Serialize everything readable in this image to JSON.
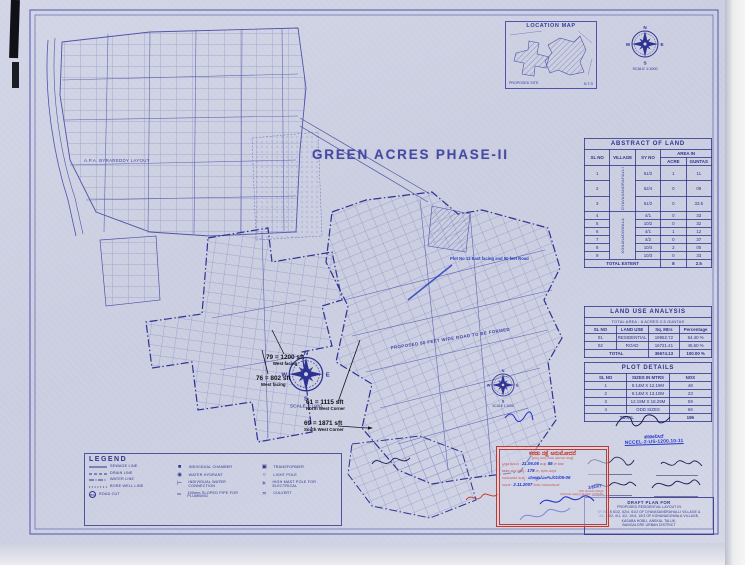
{
  "sheet": {
    "title": "GREEN ACRES PHASE-II",
    "scale_caption": "SCALE 1:1000",
    "compass": {
      "n": "N",
      "s": "S",
      "e": "E",
      "w": "W"
    },
    "area_label": "A.P.A. BYRAREDDY LAYOUT",
    "road_label": "PROPOSED 80 FEET WIDE ROAD TO BE FORMED",
    "blue_note": "Plot No 13 East facing and 50 feet Road",
    "annotations": [
      {
        "text": "79 = 1200 sft",
        "sub": "West facing"
      },
      {
        "text": "76 = 802 sft",
        "sub": "West facing"
      },
      {
        "text": "61 = 1115 sft",
        "sub": "North West Corner"
      },
      {
        "text": "69 = 1871 sft",
        "sub": "South West Corner"
      }
    ]
  },
  "location_map": {
    "title": "LOCATION MAP",
    "site_label": "PROPOSED SITE",
    "nts": "N.T.S"
  },
  "abstract": {
    "title": "ABSTRACT OF LAND",
    "headers": {
      "sl": "SL NO",
      "village": "VILLAGE",
      "sy": "SY NO",
      "area": "AREA IN",
      "acre": "ACRE",
      "guntas": "GUNTAS"
    },
    "villages": [
      "DYAVASANDRAHALLI",
      "KONANADOWALA"
    ],
    "rows": [
      {
        "sl": "1",
        "sy": "61/2",
        "acre": "1",
        "guntas": "11"
      },
      {
        "sl": "2",
        "sy": "62/4",
        "acre": "0",
        "guntas": "09"
      },
      {
        "sl": "3",
        "sy": "61/2",
        "acre": "0",
        "guntas": "33.5"
      },
      {
        "sl": "4",
        "sy": "4/1",
        "acre": "0",
        "guntas": "33"
      },
      {
        "sl": "5",
        "sy": "10/2",
        "acre": "0",
        "guntas": "32"
      },
      {
        "sl": "6",
        "sy": "4/1",
        "acre": "1",
        "guntas": "12"
      },
      {
        "sl": "7",
        "sy": "4/2",
        "acre": "0",
        "guntas": "37"
      },
      {
        "sl": "8",
        "sy": "10/4",
        "acre": "2",
        "guntas": "00"
      },
      {
        "sl": "9",
        "sy": "10/3",
        "acre": "0",
        "guntas": "33"
      }
    ],
    "total": {
      "label": "TOTAL EXTENT",
      "acre": "8",
      "guntas": "2.5"
    }
  },
  "land_use": {
    "title": "LAND USE ANALYSIS",
    "subtitle": "TOTAL AREA : 8 ACRES 2.5 GUNTAS",
    "headers": {
      "sl": "SL NO",
      "use": "LAND USE",
      "area": "Sq. Mtrs",
      "pct": "Percentage"
    },
    "rows": [
      {
        "sl": "01",
        "use": "RESIDENTIAL",
        "area": "19952.72",
        "pct": "54.40 %"
      },
      {
        "sl": "02",
        "use": "ROAD",
        "area": "16721.41",
        "pct": "45.60 %"
      }
    ],
    "total": {
      "label": "TOTAL",
      "area": "36674.13",
      "pct": "100.00 %"
    }
  },
  "plot_details": {
    "title": "PLOT DETAILS",
    "headers": {
      "sl": "SL NO",
      "size": "SIZES IN MTRS",
      "nos": "NOS"
    },
    "rows": [
      {
        "sl": "1",
        "size": "9.14M X 12.19M",
        "nos": "48"
      },
      {
        "sl": "2",
        "size": "9.14M X 13.10M",
        "nos": "23"
      },
      {
        "sl": "3",
        "size": "12.19M X 18.29M",
        "nos": "59"
      },
      {
        "sl": "4",
        "size": "ODD SIZES",
        "nos": "66"
      }
    ],
    "total": {
      "label": "TOTAL",
      "nos": "196"
    }
  },
  "signature_area": {
    "note": "ಪರಿಶೀಲಿಸಿದೆ",
    "ref": "NCCEL-2-US-1200.10-11"
  },
  "title_block": {
    "lines": [
      "DRAFT PLAN FOR",
      "PROPOSED RESIDENTIAL LAYOUT IN",
      "SY NO.S 61/2, 62/4, 61/2 OF DYAVASANDRAHALLI VILLAGE &",
      "4/1, 10/2, 4/1, 4/2, 10/4, 10/3 OF KONANADOWALA VILLAGE,",
      "KASABA HOBLI, ANEKAL TALUK,",
      "BANGALORE URBAN DISTRICT"
    ]
  },
  "stamp": {
    "title": "ಕರಡು ನಕ್ಷೆ ಅನುಮೋದನೆ",
    "subtitle": "(ಮಾನ್ಯ ಅವಧಿ ಎರಡು ವರ್ಷಗಳು ಮಾತ್ರ)",
    "lines": [
      {
        "r1": "ಸ್ವೀಕೃತ ದಿನಾಂಕ :",
        "b1": "21.06.05",
        "r2": "ಮತ್ತು",
        "b2": "55",
        "r3": "ನೇ ಕಡತ"
      },
      {
        "r1": "ಕಡತದ ಹಾಳೆ ಸಂಖ್ಯೆ :",
        "b1": "178",
        "r2": "ನೇ, ಕಛೇರಿ ಟಿಪ್ಪಣಿ"
      },
      {
        "r1": "ಅನುಮೋದನೆ ಸಂಖ್ಯೆ :",
        "b1": "ಬೆಂಅಪ್ರಾ/ಎಲ್ಒ/01/05-06"
      },
      {
        "r1": "ದಿನಾಂಕ :",
        "b1": "2.11.2007",
        "r2": "ರಂದು ಅನುಮೋದಿಸಿದೆ"
      }
    ],
    "footer1": "ನಗರ ಯೋಜನಾ ಸದಸ್ಯರು",
    "footer2": "ಬೆಂಗಳೂರು ಅಭಿವೃದ್ಧಿ ಪ್ರಾಧಿಕಾರ, ಬೆಂಗಳೂರು",
    "date_note": "3/11/07"
  },
  "legend": {
    "title": "LEGEND",
    "col1": [
      {
        "label": "SEWAGE LINE"
      },
      {
        "label": "DRAIN LINE"
      },
      {
        "label": "WATER LINE"
      },
      {
        "label": "BORE WELL LINE"
      },
      {
        "label": "ROAD CUT",
        "glyph": "BW"
      }
    ],
    "col2": [
      {
        "glyph": "■",
        "label": "INDIVIDUAL CHAMBER"
      },
      {
        "glyph": "◉",
        "label": "WATER HYDRANT"
      },
      {
        "glyph": "⊢",
        "label": "INDIVIDUAL WATER CONNECTION"
      },
      {
        "glyph": "═",
        "label": "150mm SLOPED PIPE FOR PLUMBING"
      }
    ],
    "col3": [
      {
        "glyph": "▣",
        "label": "TRANSFORMER"
      },
      {
        "glyph": "○",
        "label": "LIGHT POLE"
      },
      {
        "glyph": "✳",
        "label": "HIGH MAST POLE FOR ELECTRICAL"
      },
      {
        "glyph": "≍",
        "label": "CULVERT"
      }
    ]
  }
}
